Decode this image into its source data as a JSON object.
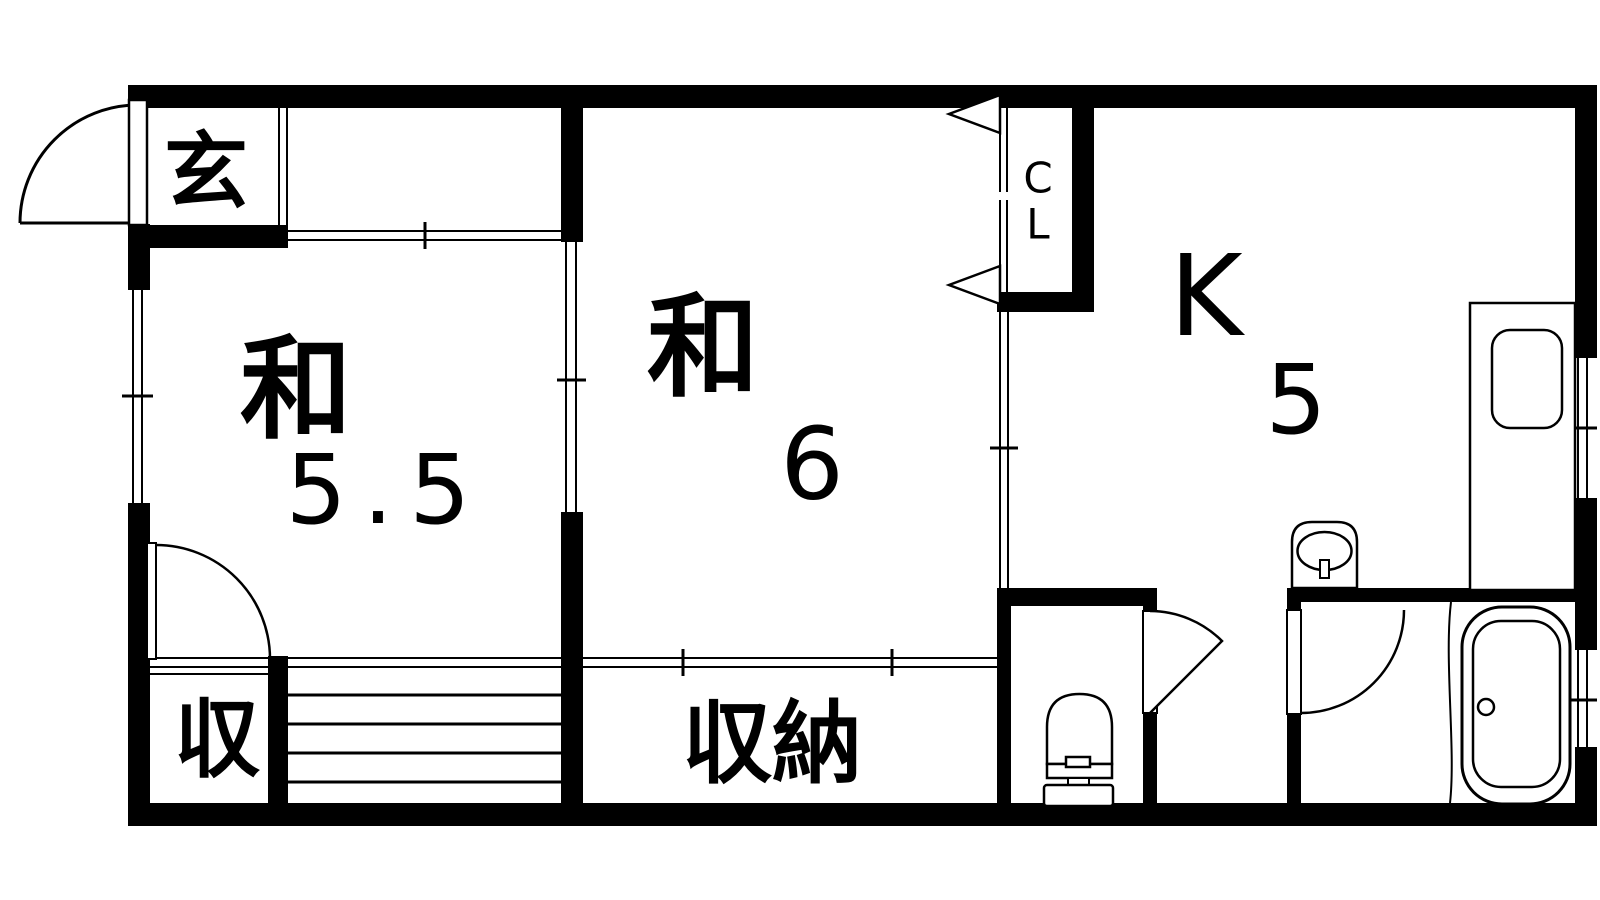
{
  "type": "floor_plan",
  "plan": {
    "rooms": {
      "genkan": {
        "label": "玄"
      },
      "japanese_room_5_5": {
        "label": "和",
        "size": "5.5"
      },
      "japanese_room_6": {
        "label": "和",
        "size": "6"
      },
      "kitchen": {
        "label": "K",
        "size": "5"
      },
      "closet": {
        "label_line1": "C",
        "label_line2": "L"
      },
      "storage_small": {
        "label": "収"
      },
      "storage_large": {
        "label": "収納"
      }
    },
    "colors": {
      "wall": "#000000",
      "line": "#000000",
      "background": "#ffffff"
    }
  }
}
